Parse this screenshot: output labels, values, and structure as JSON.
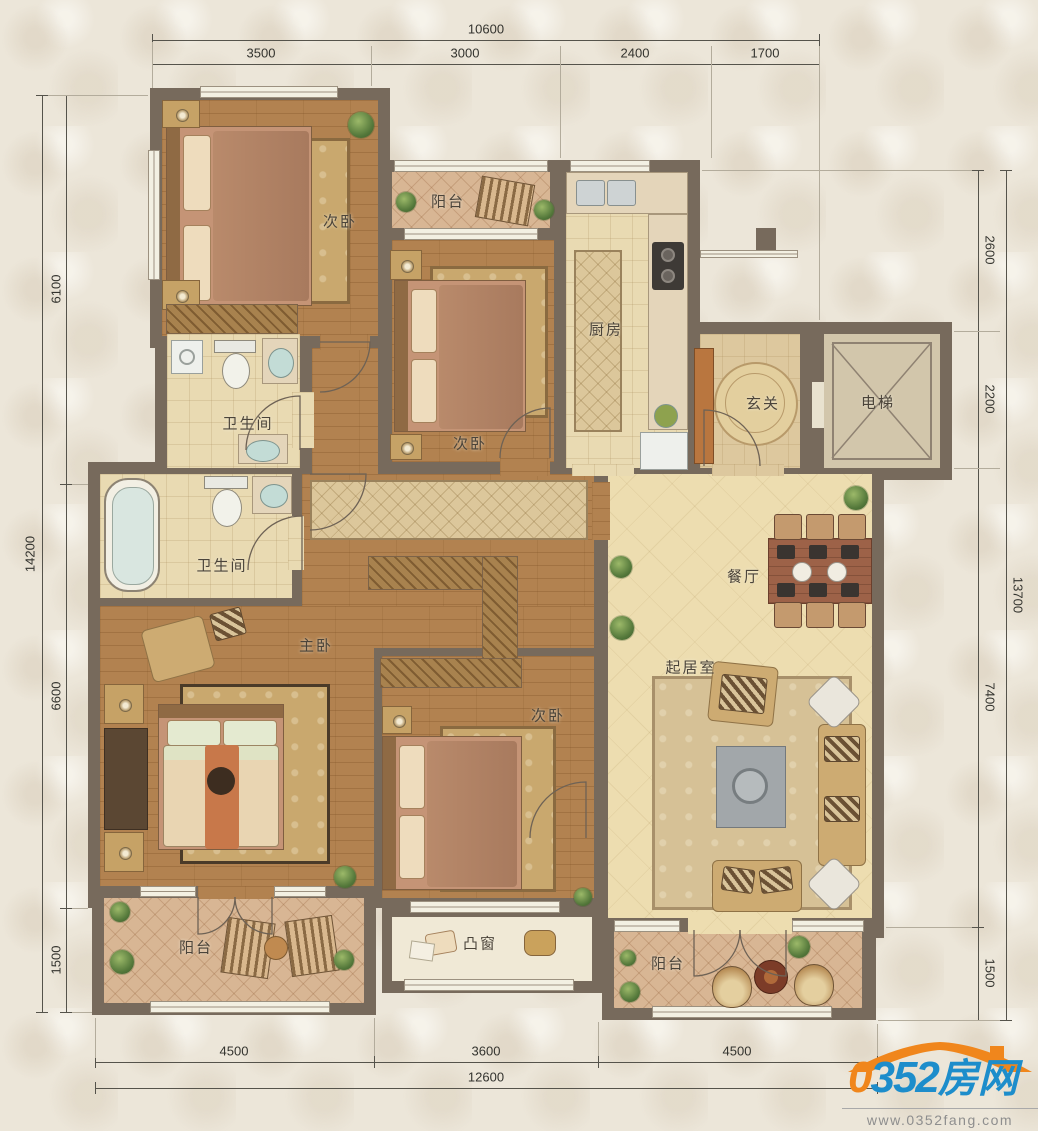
{
  "rooms": [
    {
      "id": "bedroom-top-left",
      "label": "次卧"
    },
    {
      "id": "balcony-top",
      "label": "阳台"
    },
    {
      "id": "bedroom-middle",
      "label": "次卧"
    },
    {
      "id": "kitchen",
      "label": "厨房"
    },
    {
      "id": "foyer",
      "label": "玄关"
    },
    {
      "id": "elevator",
      "label": "电梯"
    },
    {
      "id": "bathroom-upper",
      "label": "卫生间"
    },
    {
      "id": "bathroom-lower",
      "label": "卫生间"
    },
    {
      "id": "master-bedroom",
      "label": "主卧"
    },
    {
      "id": "dining-room",
      "label": "餐厅"
    },
    {
      "id": "living-room",
      "label": "起居室"
    },
    {
      "id": "bedroom-bottom",
      "label": "次卧"
    },
    {
      "id": "balcony-bottom-left",
      "label": "阳台"
    },
    {
      "id": "bay-window",
      "label": "凸窗"
    },
    {
      "id": "balcony-bottom-right",
      "label": "阳台"
    }
  ],
  "dimensions": {
    "top": {
      "total": "10600",
      "segments": [
        "3500",
        "3000",
        "2400",
        "1700"
      ]
    },
    "left": {
      "total": "14200",
      "segments": [
        "6100",
        "6600",
        "1500"
      ]
    },
    "right": {
      "total": "13700",
      "segments": [
        "2600",
        "2200",
        "7400",
        "1500"
      ]
    },
    "bottom": {
      "total": "12600",
      "segments": [
        "4500",
        "3600",
        "4500"
      ]
    }
  },
  "branding": {
    "logo_zero": "0",
    "logo_num": "352",
    "logo_cn": "房网",
    "website": "www.0352fang.com"
  },
  "colors": {
    "wall": "#776a5c",
    "wood_floor": "#b28250",
    "tile_floor": "#e9dab2",
    "balcony_tile": "#d8b694",
    "living_floor": "#edddb0",
    "accent_orange": "#f0861c",
    "accent_blue": "#1d8dcb"
  }
}
